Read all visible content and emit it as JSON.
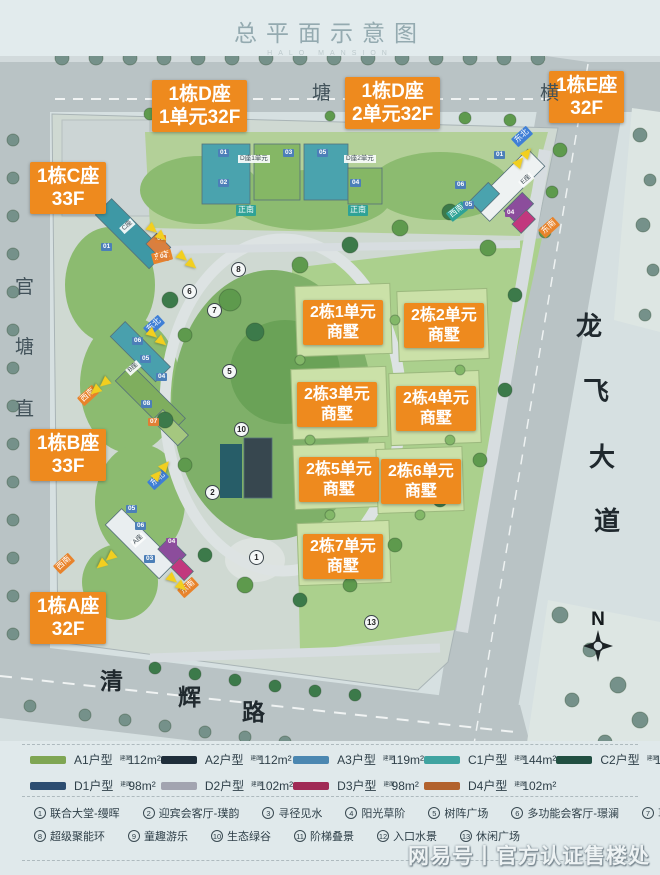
{
  "header": {
    "title": "总平面示意图",
    "subtitle": "HALO MANSION"
  },
  "map": {
    "tower_labels": [
      {
        "line1": "1栋D座",
        "line2": "1单元32F",
        "x": 152,
        "y": 80,
        "fs": 19
      },
      {
        "line1": "1栋D座",
        "line2": "2单元32F",
        "x": 345,
        "y": 77,
        "fs": 19
      },
      {
        "line1": "1栋E座",
        "line2": "32F",
        "x": 549,
        "y": 71,
        "fs": 19
      },
      {
        "line1": "1栋C座",
        "line2": "33F",
        "x": 30,
        "y": 162,
        "fs": 19
      },
      {
        "line1": "1栋B座",
        "line2": "33F",
        "x": 30,
        "y": 429,
        "fs": 19
      },
      {
        "line1": "1栋A座",
        "line2": "32F",
        "x": 30,
        "y": 592,
        "fs": 19
      },
      {
        "line1": "2栋1单元",
        "line2": "商墅",
        "x": 303,
        "y": 300,
        "fs": 16
      },
      {
        "line1": "2栋2单元",
        "line2": "商墅",
        "x": 404,
        "y": 303,
        "fs": 16
      },
      {
        "line1": "2栋3单元",
        "line2": "商墅",
        "x": 297,
        "y": 382,
        "fs": 16
      },
      {
        "line1": "2栋4单元",
        "line2": "商墅",
        "x": 396,
        "y": 386,
        "fs": 16
      },
      {
        "line1": "2栋5单元",
        "line2": "商墅",
        "x": 299,
        "y": 457,
        "fs": 16
      },
      {
        "line1": "2栋6单元",
        "line2": "商墅",
        "x": 381,
        "y": 459,
        "fs": 16
      },
      {
        "line1": "2栋7单元",
        "line2": "商墅",
        "x": 303,
        "y": 534,
        "fs": 16
      }
    ],
    "direction_tags": [
      {
        "t": "东北",
        "x": 512,
        "y": 131,
        "r": -42,
        "c": "blue"
      },
      {
        "t": "西南",
        "x": 447,
        "y": 206,
        "r": -38,
        "c": "teal"
      },
      {
        "t": "东南",
        "x": 539,
        "y": 222,
        "r": -42,
        "c": "orange"
      },
      {
        "t": "正南",
        "x": 236,
        "y": 205,
        "r": 0,
        "c": "teal"
      },
      {
        "t": "正南",
        "x": 348,
        "y": 205,
        "r": 0,
        "c": "teal"
      },
      {
        "t": "东南",
        "x": 152,
        "y": 251,
        "r": -15,
        "c": "orange"
      },
      {
        "t": "东北",
        "x": 144,
        "y": 320,
        "r": -42,
        "c": "blue"
      },
      {
        "t": "西南",
        "x": 78,
        "y": 390,
        "r": -42,
        "c": "orange"
      },
      {
        "t": "东北",
        "x": 148,
        "y": 474,
        "r": -42,
        "c": "blue"
      },
      {
        "t": "西南",
        "x": 54,
        "y": 558,
        "r": -42,
        "c": "orange"
      },
      {
        "t": "东南",
        "x": 178,
        "y": 582,
        "r": -42,
        "c": "orange"
      }
    ],
    "unit_chips": [
      {
        "t": "01",
        "x": 218,
        "y": 149,
        "c": "blue"
      },
      {
        "t": "02",
        "x": 218,
        "y": 179,
        "c": "blue"
      },
      {
        "t": "03",
        "x": 283,
        "y": 149,
        "c": "blue"
      },
      {
        "t": "05",
        "x": 317,
        "y": 149,
        "c": "blue"
      },
      {
        "t": "04",
        "x": 350,
        "y": 179,
        "c": "blue"
      },
      {
        "t": "01",
        "x": 494,
        "y": 151,
        "c": "blue"
      },
      {
        "t": "06",
        "x": 455,
        "y": 181,
        "c": "blue"
      },
      {
        "t": "05",
        "x": 463,
        "y": 201,
        "c": "blue"
      },
      {
        "t": "04",
        "x": 505,
        "y": 209,
        "c": "purple"
      },
      {
        "t": "01",
        "x": 101,
        "y": 243,
        "c": "blue"
      },
      {
        "t": "03",
        "x": 155,
        "y": 235,
        "c": "orange"
      },
      {
        "t": "04",
        "x": 158,
        "y": 253,
        "c": "orange"
      },
      {
        "t": "06",
        "x": 132,
        "y": 337,
        "c": "blue"
      },
      {
        "t": "05",
        "x": 140,
        "y": 355,
        "c": "blue"
      },
      {
        "t": "04",
        "x": 156,
        "y": 373,
        "c": "blue"
      },
      {
        "t": "08",
        "x": 141,
        "y": 400,
        "c": "blue"
      },
      {
        "t": "07",
        "x": 148,
        "y": 418,
        "c": "orange"
      },
      {
        "t": "05",
        "x": 126,
        "y": 505,
        "c": "blue"
      },
      {
        "t": "06",
        "x": 135,
        "y": 522,
        "c": "blue"
      },
      {
        "t": "04",
        "x": 166,
        "y": 538,
        "c": "purple"
      },
      {
        "t": "03",
        "x": 144,
        "y": 555,
        "c": "blue"
      }
    ],
    "cluster_labels": [
      {
        "t": "C座",
        "x": 120,
        "y": 222,
        "r": -42
      },
      {
        "t": "B座",
        "x": 126,
        "y": 364,
        "r": -42
      },
      {
        "t": "A座",
        "x": 131,
        "y": 536,
        "r": -42
      },
      {
        "t": "E座",
        "x": 519,
        "y": 176,
        "r": -42
      },
      {
        "t": "D座1单元",
        "x": 238,
        "y": 155,
        "r": 0
      },
      {
        "t": "D座2单元",
        "x": 344,
        "y": 155,
        "r": 0
      }
    ],
    "markers": [
      {
        "n": "8",
        "x": 231,
        "y": 262
      },
      {
        "n": "6",
        "x": 182,
        "y": 284
      },
      {
        "n": "7",
        "x": 207,
        "y": 303
      },
      {
        "n": "5",
        "x": 222,
        "y": 364
      },
      {
        "n": "10",
        "x": 234,
        "y": 422
      },
      {
        "n": "2",
        "x": 205,
        "y": 485
      },
      {
        "n": "1",
        "x": 249,
        "y": 550
      },
      {
        "n": "13",
        "x": 364,
        "y": 615
      }
    ],
    "arrows": [
      {
        "x": 146,
        "y": 228,
        "r": 40
      },
      {
        "x": 512,
        "y": 152,
        "r": -50
      },
      {
        "x": 176,
        "y": 256,
        "r": 40
      },
      {
        "x": 146,
        "y": 333,
        "r": 40
      },
      {
        "x": 88,
        "y": 382,
        "r": 140
      },
      {
        "x": 150,
        "y": 465,
        "r": -50
      },
      {
        "x": 94,
        "y": 556,
        "r": 140
      },
      {
        "x": 166,
        "y": 578,
        "r": 40
      }
    ],
    "roads": [
      {
        "name": "塘横街",
        "cls": "",
        "fs": 19,
        "chars": [
          {
            "t": "塘",
            "x": 312,
            "y": 78
          },
          {
            "t": "横",
            "x": 540,
            "y": 78
          }
        ]
      },
      {
        "name": "官塘直街",
        "cls": "",
        "fs": 19,
        "chars": [
          {
            "t": "官",
            "x": 15,
            "y": 272
          },
          {
            "t": "塘",
            "x": 15,
            "y": 332
          },
          {
            "t": "直",
            "x": 15,
            "y": 394
          }
        ]
      },
      {
        "name": "龙飞大道",
        "cls": "big",
        "fs": 26,
        "chars": [
          {
            "t": "龙",
            "x": 576,
            "y": 306
          },
          {
            "t": "飞",
            "x": 583,
            "y": 371
          },
          {
            "t": "大",
            "x": 589,
            "y": 437
          },
          {
            "t": "道",
            "x": 594,
            "y": 501
          }
        ]
      },
      {
        "name": "清辉路",
        "cls": "big",
        "fs": 23,
        "chars": [
          {
            "t": "清",
            "x": 100,
            "y": 662
          },
          {
            "t": "辉",
            "x": 178,
            "y": 678
          },
          {
            "t": "路",
            "x": 242,
            "y": 693
          }
        ]
      }
    ]
  },
  "compass": {
    "label": "N"
  },
  "legend": {
    "area_prefix": "建面",
    "units": [
      {
        "name": "A1户型",
        "area": "112m²",
        "color": "#7fa653"
      },
      {
        "name": "A2户型",
        "area": "112m²",
        "color": "#1f2e3a"
      },
      {
        "name": "A3户型",
        "area": "119m²",
        "color": "#4b87b1"
      },
      {
        "name": "C1户型",
        "area": "144m²",
        "color": "#3fa3a0"
      },
      {
        "name": "C2户型",
        "area": "144m²",
        "color": "#214f41"
      },
      {
        "name": "D1户型",
        "area": "98m²",
        "color": "#2c4d71"
      },
      {
        "name": "D2户型",
        "area": "102m²",
        "color": "#a2a4b0"
      },
      {
        "name": "D3户型",
        "area": "98m²",
        "color": "#a02a55"
      },
      {
        "name": "D4户型",
        "area": "102m²",
        "color": "#b2622d"
      }
    ],
    "amenities": [
      {
        "num": "1",
        "label": "联合大堂-缦晖",
        "row": 1
      },
      {
        "num": "2",
        "label": "迎宾会客厅-璞韵",
        "row": 1
      },
      {
        "num": "3",
        "label": "寻径见水",
        "row": 1
      },
      {
        "num": "4",
        "label": "阳光草阶",
        "row": 1
      },
      {
        "num": "5",
        "label": "树阵广场",
        "row": 1
      },
      {
        "num": "6",
        "label": "多功能会客厅-璟澜",
        "row": 1
      },
      {
        "num": "7",
        "label": "草坪剧场",
        "row": 1
      },
      {
        "num": "8",
        "label": "超级聚能环",
        "row": 2
      },
      {
        "num": "9",
        "label": "童趣游乐",
        "row": 2
      },
      {
        "num": "10",
        "label": "生态绿谷",
        "row": 2
      },
      {
        "num": "11",
        "label": "阶梯叠景",
        "row": 2
      },
      {
        "num": "12",
        "label": "入口水景",
        "row": 2
      },
      {
        "num": "13",
        "label": "休闲广场",
        "row": 2
      }
    ]
  },
  "watermark": {
    "text": "网易号丨官方认证售楼处"
  }
}
